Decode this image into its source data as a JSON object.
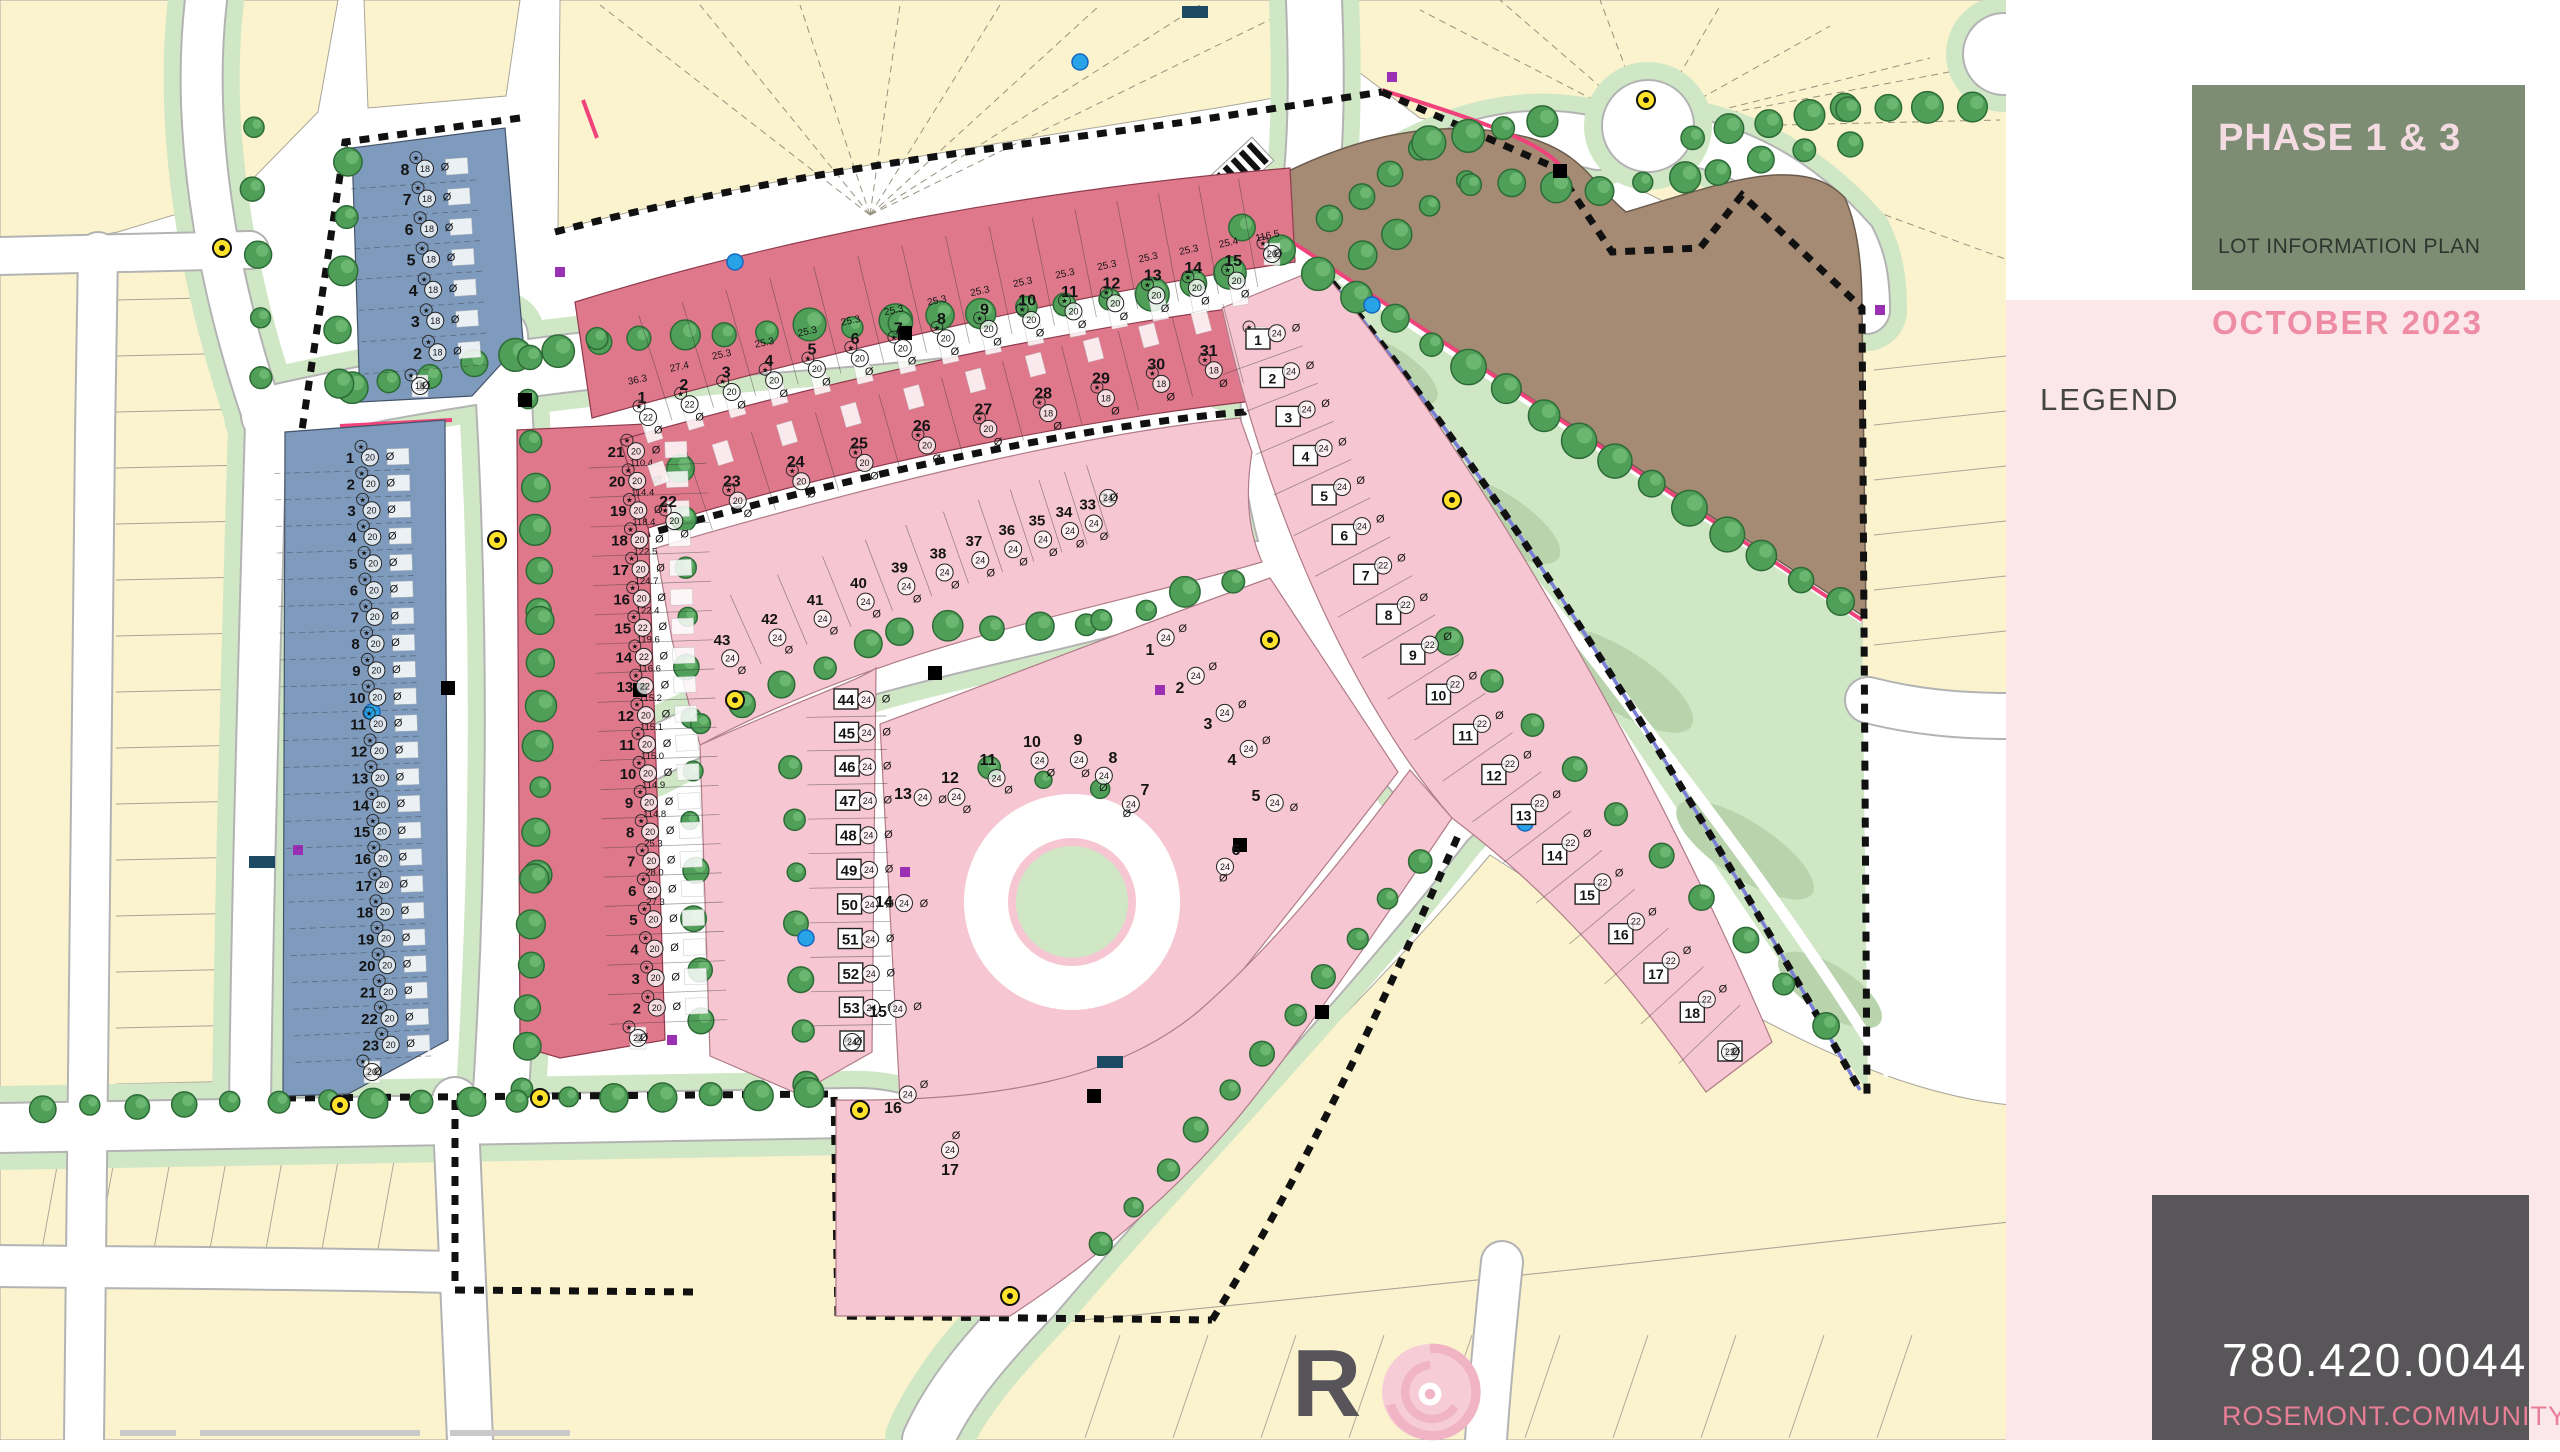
{
  "title_panel": {
    "phase": "PHASE 1 & 3",
    "subtitle": "LOT INFORMATION PLAN",
    "date": "OCTOBER 2023"
  },
  "legend": {
    "title": "LEGEND",
    "items": [
      {
        "icon": "swatch-front",
        "label": "FRONT DRIVE",
        "color": "#f6c6d2"
      },
      {
        "icon": "swatch-rear",
        "label": "REAR DRIVE",
        "color": "#e0788c"
      },
      {
        "icon": "swatch-townhouse",
        "label": "TOWNHOUSE",
        "color": "#7e9abc"
      },
      {
        "icon": "swatch-future",
        "label": "FUTURE / EXISTING RESIDENTIAL",
        "color": "#fafac8"
      },
      {
        "icon": "swatch-zero",
        "label": "ZERO LOT LINE",
        "color": "#c9cfcf"
      },
      {
        "icon": "circle-width",
        "label": "SUGGESTED HOUSE WIDTH",
        "label2": "IN FEET AT FRONTAGE SHOWN",
        "value": "22"
      },
      {
        "icon": "frontage",
        "label": "LOT FRONTAGE",
        "value": "24.61"
      },
      {
        "icon": "box-special",
        "label": "SPECIAL TREATMENTS TO",
        "label2": "SIDE/REAR ELEVATION REQUIRED",
        "value": "15"
      },
      {
        "icon": "transformer",
        "label": "TRANSFORMER",
        "color": "#000000"
      },
      {
        "icon": "light-standard",
        "label": "LIGHT STANDARD",
        "color": "#ffe32b"
      },
      {
        "icon": "fire-hydrant",
        "label": "FIRE HYDRANT",
        "color": "#29a3e8"
      },
      {
        "icon": "pedestal",
        "label": "PEDESTAL / VAULT",
        "color": "#9b30b5"
      },
      {
        "icon": "mailbox",
        "label": "MAIL BOX",
        "color": "#1c4a63"
      },
      {
        "icon": "driveway-arrow",
        "label": "DRIVEWAY LOCATION",
        "color": "#8a8a8a"
      },
      {
        "icon": "tree",
        "label": "PROPOSED TREE / SHRUB LOCATIONS",
        "label2": "SUBJECT TO CHANGE)",
        "color": "#3fae49"
      },
      {
        "icon": "phase-boundary",
        "label": "PHASE BOUNDARY",
        "color": "#111111"
      },
      {
        "icon": "wood-fence",
        "label": "WOOD SCREEN FENCE",
        "color": "#f0437c"
      },
      {
        "icon": "chain-fence",
        "label": "CHAIN LINK FENCE",
        "color": "#7a7fd6"
      },
      {
        "icon": "roof-leader",
        "label": "ROOF LEADER CONNECTION",
        "label2": "TO STORM SERVICE REQUIRED"
      },
      {
        "icon": "net-zero",
        "label": "NET ZERO READY"
      }
    ]
  },
  "contact": {
    "phone": "780.420.0044",
    "website": "ROSEMONT.COMMUNITY"
  },
  "brand": {
    "letter_r": "R",
    "letters_rest": [
      "S",
      "E",
      "M",
      "O",
      "N",
      "T"
    ]
  },
  "north": {
    "label": "NORTH"
  },
  "map": {
    "phase1_label": "Phase 1",
    "phase3_label": "Phase 3",
    "multi_family_label": "MULTI-FAMILY SITE",
    "streets": [
      {
        "id": "88-ave-ne",
        "name": "88 AVENUE NW"
      },
      {
        "id": "88-ave-center",
        "name": "88 AVENUE NW"
      },
      {
        "id": "rosenthal-drive",
        "name": "ROSENTHAL DRIVE NW"
      },
      {
        "id": "224-street",
        "name": "224 STREET NW"
      },
      {
        "id": "87a-avenue",
        "name": "87A AVENUE NW"
      },
      {
        "id": "226-street",
        "name": "226 STREET NW"
      },
      {
        "id": "87-avenue-west",
        "name": "87 AVENUE NW"
      },
      {
        "id": "87-avenue-se",
        "name": "87 AVENUE NW"
      }
    ],
    "blocks": [
      {
        "id": "blk6",
        "label": "BLK 6",
        "type": "townhouse",
        "house_width": 18,
        "lots": [
          8,
          7,
          6,
          5,
          4,
          3,
          2,
          1
        ],
        "frontages_shown": [
          "114.8",
          "26.2",
          "22.3",
          "18.0",
          "20.2"
        ]
      },
      {
        "id": "blk5-west",
        "label": "BLK 5",
        "type": "townhouse",
        "house_width": 20,
        "lots": [
          1,
          2,
          3,
          4,
          5,
          6,
          7,
          8,
          9,
          10,
          11,
          12,
          13,
          14,
          15,
          16,
          17,
          18,
          19,
          20,
          21,
          22,
          23,
          24
        ],
        "frontages_shown": [
          "34.8",
          "20.0",
          "24.3",
          "114.8",
          "26.2",
          "35.2"
        ]
      },
      {
        "id": "rosenthal-east",
        "label": "",
        "type": "rear-drive",
        "lots": [
          21,
          20,
          19,
          18,
          17,
          16,
          15,
          14,
          13,
          12,
          11,
          10,
          9,
          8,
          7,
          6,
          5,
          4,
          3,
          2,
          1
        ],
        "house_widths": [
          20,
          20,
          20,
          20,
          20,
          20,
          22,
          22,
          22,
          20,
          20,
          20,
          20,
          20,
          20,
          20,
          20,
          20,
          20,
          20,
          22
        ],
        "frontages_shown": [
          "28.2",
          "110.4",
          "114.4",
          "118.4",
          "122.5",
          "124.7",
          "122.4",
          "119.6",
          "116.6",
          "115.2",
          "115.1",
          "115.0",
          "114.9",
          "114.8",
          "25.3",
          "28.0",
          "27.3"
        ]
      },
      {
        "id": "blk2",
        "label": "BLK 2",
        "type": "rear-drive",
        "lots": [
          1,
          2,
          3,
          4,
          5,
          6,
          7,
          8,
          9,
          10,
          11,
          12,
          13,
          14,
          15,
          16
        ],
        "house_widths": [
          22,
          22,
          20,
          20,
          20,
          20,
          20,
          20,
          20,
          20,
          20,
          20,
          20,
          20,
          20,
          20
        ],
        "frontages_shown": [
          "36.3",
          "27.4",
          "25.3",
          "25.3",
          "25.3",
          "25.3",
          "25.3",
          "25.3",
          "25.3",
          "25.3",
          "25.3",
          "25.3",
          "25.3",
          "25.3",
          "25.4",
          "116.5"
        ]
      },
      {
        "id": "blk2-south",
        "label": "",
        "type": "rear-drive",
        "lots": [
          22,
          23,
          24,
          25,
          26,
          27,
          28,
          29,
          30,
          31,
          55
        ],
        "house_widths": [
          20,
          20,
          20,
          20,
          20,
          20,
          18,
          18,
          18,
          18,
          20
        ],
        "frontages_shown": [
          "29.3",
          "25.3",
          "23.3",
          "114.8",
          "28.1"
        ]
      },
      {
        "id": "blk4",
        "label": "BLK 4",
        "type": "front-drive",
        "house_width": 24,
        "lots_arc": [
          43,
          42,
          41,
          40,
          39,
          38,
          37,
          36,
          35,
          34,
          33,
          32
        ],
        "lots_col": [
          44,
          45,
          46,
          47,
          48,
          49,
          50,
          51,
          52,
          53,
          54
        ],
        "frontages_shown": [
          "126.7",
          "105.7",
          "114.3",
          "114.9",
          "104.2",
          "105.9",
          "114.8",
          "29.3",
          "27.5",
          "27.3"
        ]
      },
      {
        "id": "blk3",
        "label": "BLK 3",
        "type": "front-drive",
        "house_width": 24,
        "lots": [
          1,
          2,
          3,
          4,
          5,
          6,
          7,
          8,
          9,
          10,
          11,
          12,
          13,
          14,
          15,
          16,
          17,
          18,
          19
        ],
        "frontages_shown": [
          "117.3",
          "118.9",
          "105.2",
          "111.4",
          "126.8",
          "105.8",
          "112.8",
          "156.8",
          "140.8",
          "135.8",
          "119.9",
          "105.5",
          "32.5",
          "36.5"
        ]
      },
      {
        "id": "blk1",
        "label": "BLK 1",
        "type": "front-drive",
        "house_width": 24,
        "lots": [
          1,
          2,
          3,
          4,
          5,
          6,
          7,
          8,
          9,
          10,
          11,
          12,
          13,
          14,
          15,
          16,
          17
        ],
        "frontage": "115.0",
        "depth": "32.5",
        "first_frontage": "36.5"
      },
      {
        "id": "blk5-south",
        "label": "BLK 5",
        "type": "front-drive",
        "lots": [
          1,
          2,
          3,
          4,
          5,
          6,
          7,
          8,
          9,
          10,
          11,
          12,
          13,
          14,
          15,
          16,
          17,
          18,
          19
        ],
        "house_widths": [
          24,
          24,
          24,
          24,
          24,
          24,
          22,
          22,
          22,
          22,
          22,
          22,
          22,
          22,
          22,
          22,
          22,
          22,
          22
        ],
        "frontages_shown": [
          "114.8",
          "111.8",
          "106.5",
          "105.5",
          "105.9",
          "114.6",
          "30.5",
          "30.8",
          "32.5",
          "35.9"
        ]
      }
    ],
    "colors": {
      "front_drive": "#f6c6d2",
      "rear_drive": "#e0788c",
      "townhouse": "#7e9abc",
      "future_residential": "#faf3cd",
      "zero_lot_line": "#c9cfcf",
      "multi_family": "#a58b74",
      "green_space": "#cfe7c5",
      "tree": "#4f9f58",
      "wood_fence": "#f0437c",
      "chain_fence": "#7a7fd6"
    }
  }
}
